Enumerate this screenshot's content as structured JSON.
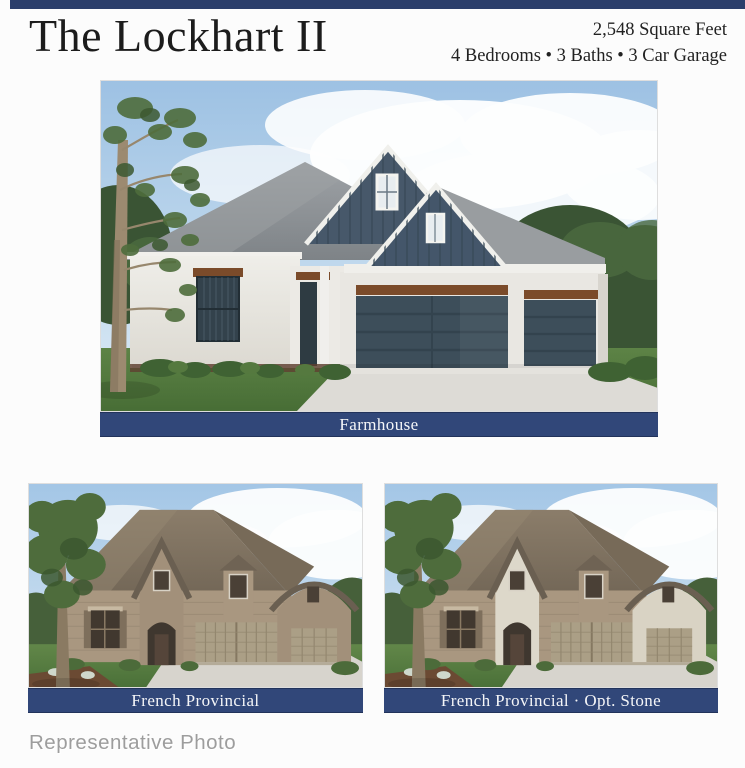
{
  "header": {
    "title": "The Lockhart II",
    "square_feet": "2,548 Square Feet",
    "details": "4 Bedrooms • 3 Baths • 3 Car Garage"
  },
  "figures": [
    {
      "caption": "Farmhouse"
    },
    {
      "caption": "French Provincial"
    },
    {
      "caption": "French Provincial · Opt. Stone"
    }
  ],
  "footer": {
    "watermark": "Representative Photo"
  },
  "colors": {
    "accent_bar": "#2b3e6b",
    "caption_background": "#314779",
    "caption_text": "#f5f6f8"
  }
}
